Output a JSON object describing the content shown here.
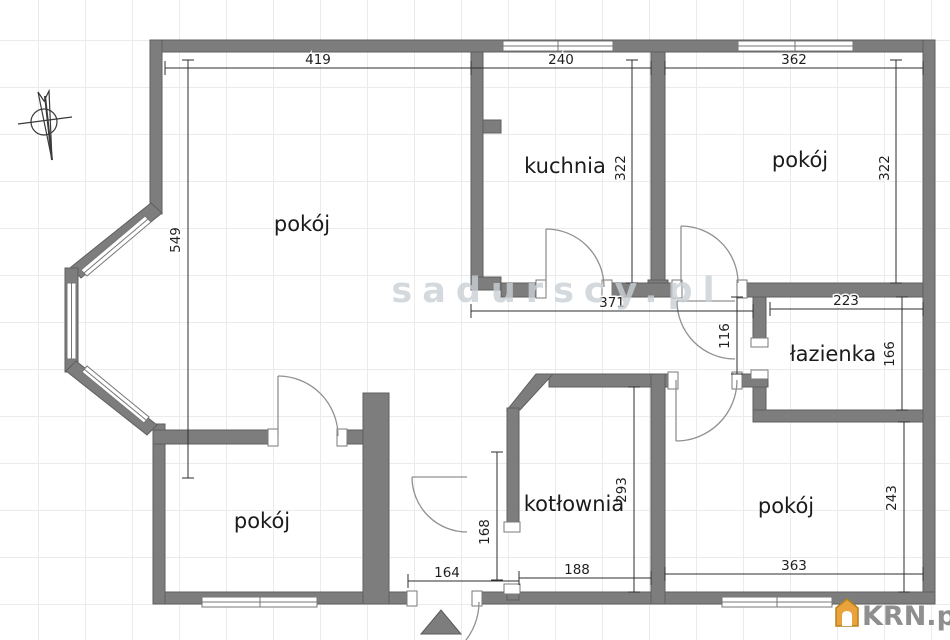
{
  "watermark": "sadurscy.pl",
  "logo": {
    "text": "KRN.pl",
    "house_color": "#EAA33C",
    "text_color": "#8f8f8f"
  },
  "colors": {
    "wall": "#7d7d7d",
    "wall_edge": "#5f5f5f",
    "grid": "#ebebeb",
    "dimension_text": "#1f1f1f"
  },
  "rooms": {
    "living": {
      "label": "pokój"
    },
    "kitchen": {
      "label": "kuchnia"
    },
    "bedroom_top_right": {
      "label": "pokój"
    },
    "bathroom": {
      "label": "łazienka"
    },
    "boiler_room": {
      "label": "kotłownia"
    },
    "bedroom_bottom_left": {
      "label": "pokój"
    },
    "bedroom_bottom_right": {
      "label": "pokój"
    }
  },
  "dimensions": {
    "living_width": "419",
    "kitchen_width": "240",
    "bedroom_tr_width": "362",
    "living_height": "549",
    "kitchen_height": "322",
    "bedroom_tr_height": "322",
    "hall_width": "371",
    "bathroom_width": "223",
    "hall_height": "116",
    "bathroom_height": "166",
    "boiler_height": "293",
    "boiler_width": "188",
    "bedroom_br_width": "363",
    "bedroom_br_height": "243",
    "vestibule_width": "164",
    "vestibule_height": "168"
  }
}
